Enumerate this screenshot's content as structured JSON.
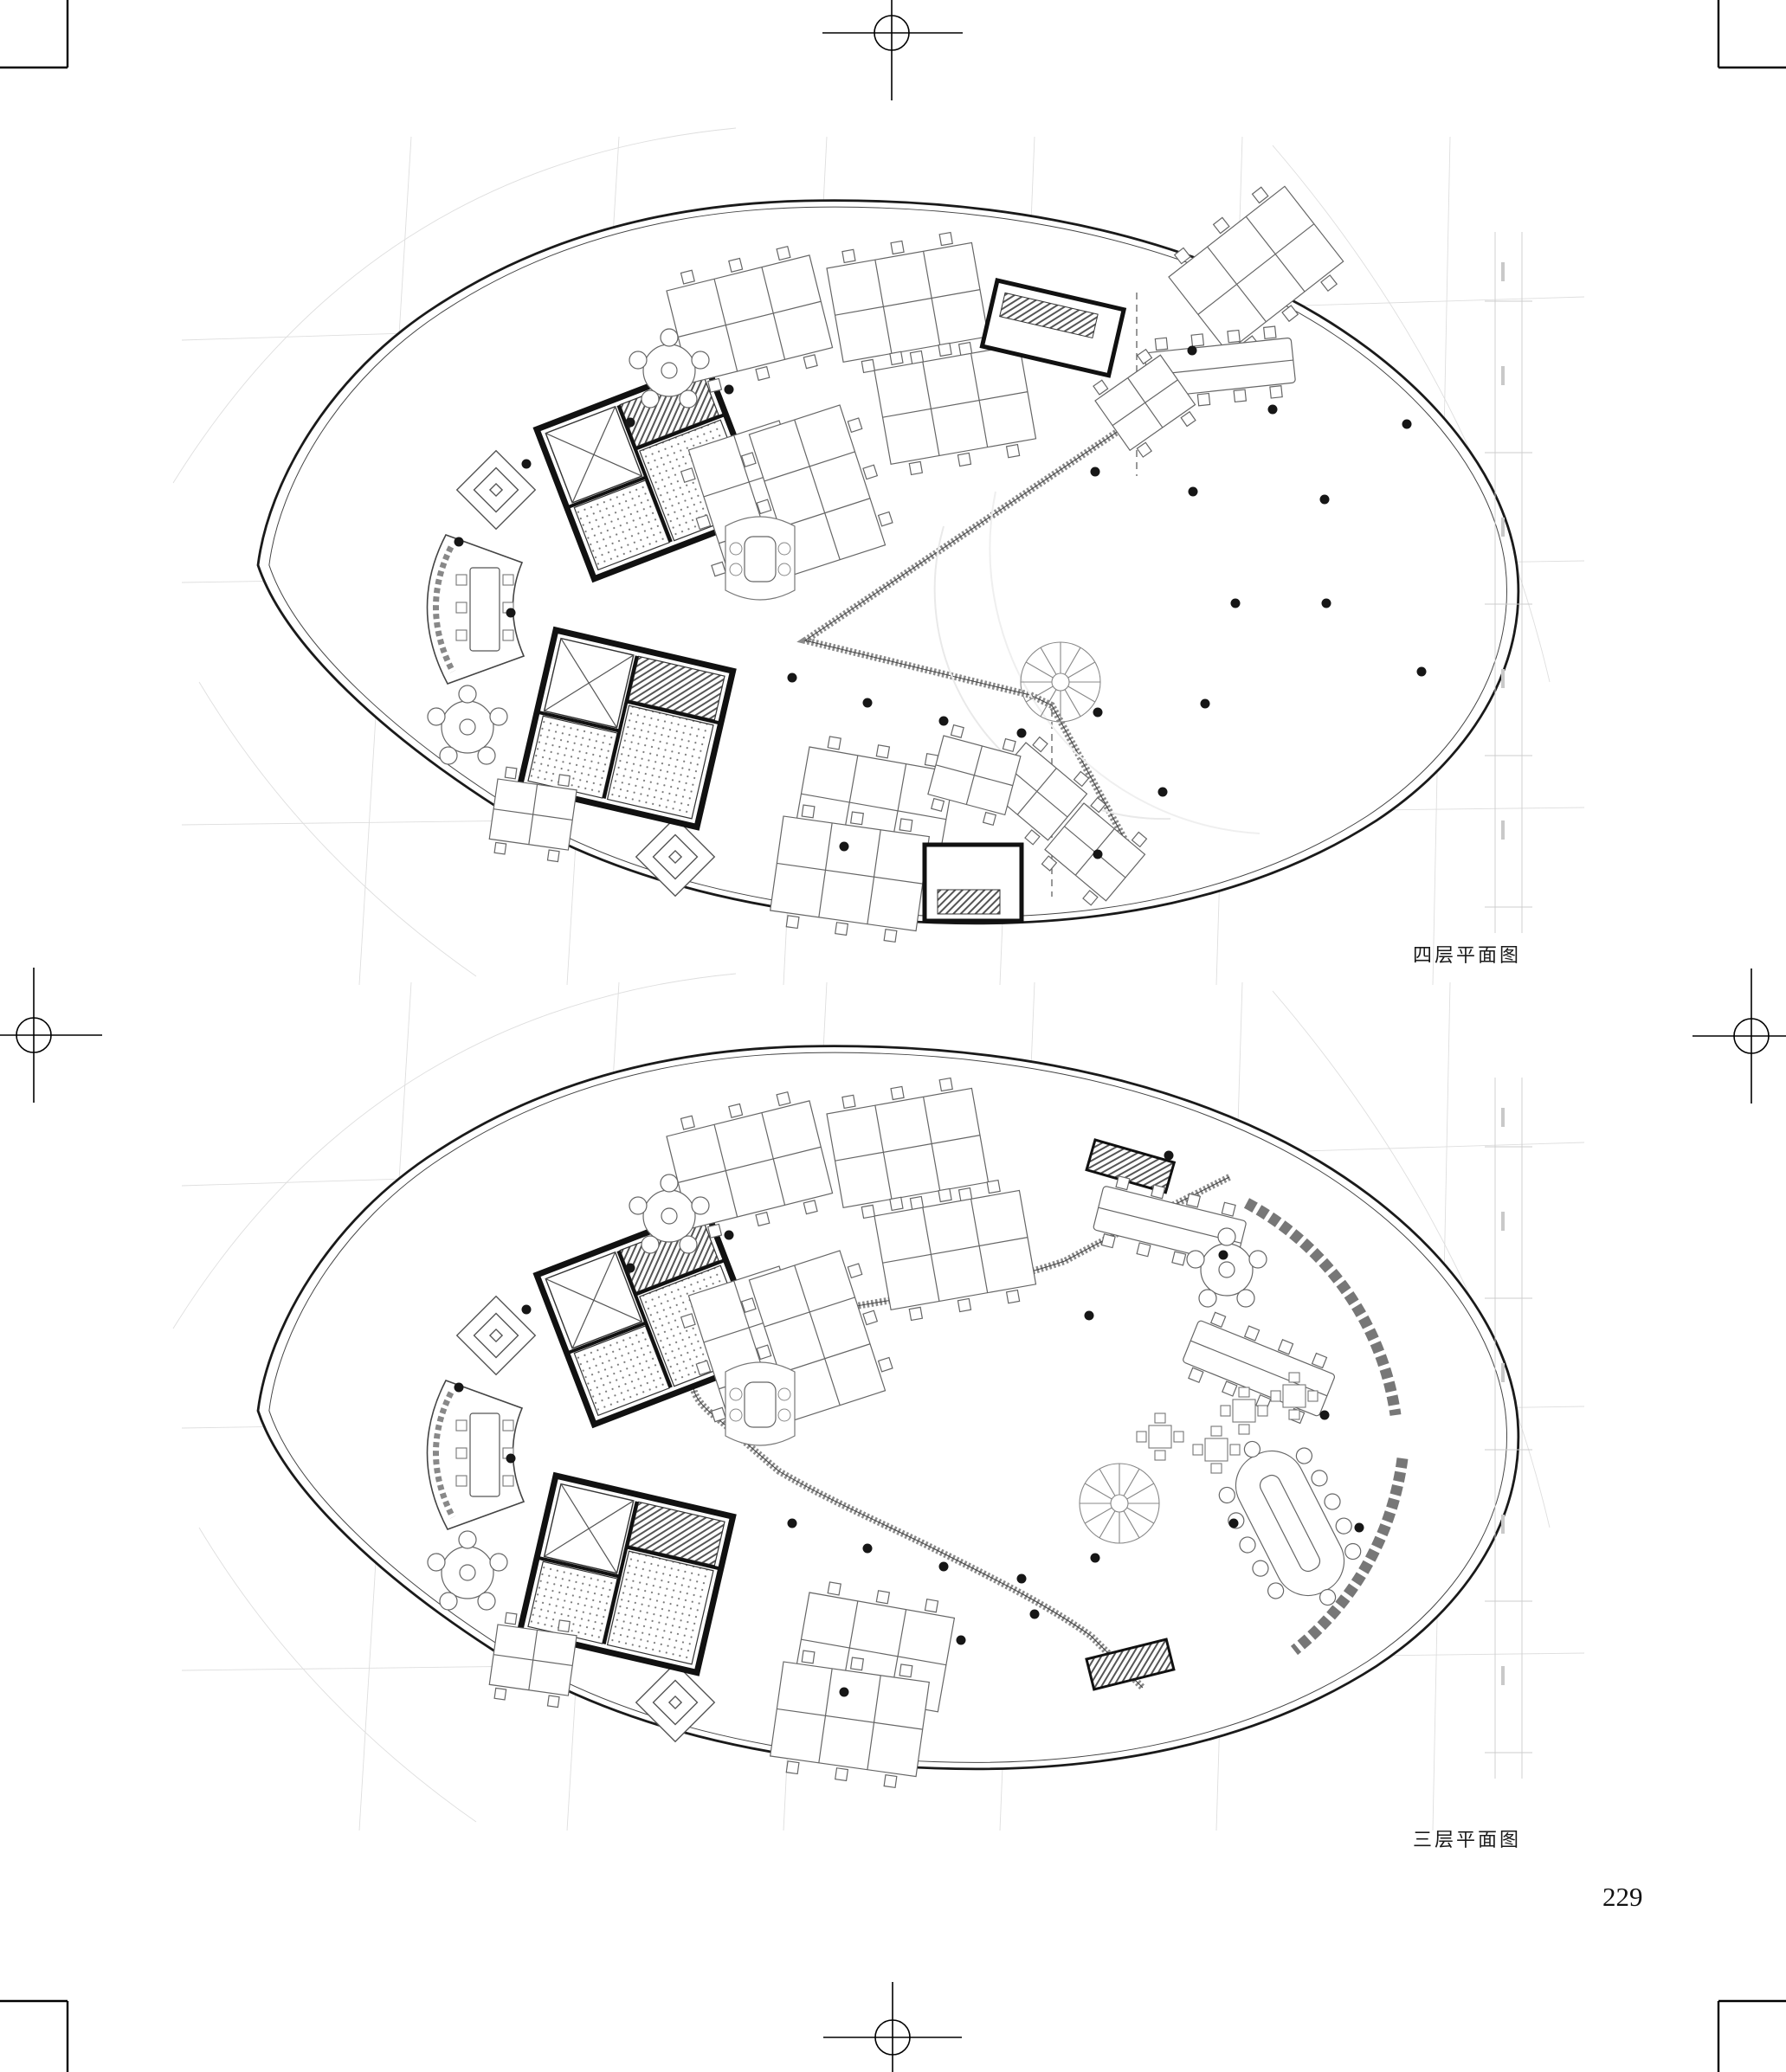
{
  "page": {
    "number": "229"
  },
  "figures": [
    {
      "id": "plan-4f",
      "caption": "四层平面图",
      "description_icon": "floor-plan-drawing"
    },
    {
      "id": "plan-3f",
      "caption": "三层平面图",
      "description_icon": "floor-plan-drawing"
    }
  ],
  "print_marks": {
    "corner_icon": "crop-mark-icon",
    "center_icon": "registration-mark-icon"
  }
}
